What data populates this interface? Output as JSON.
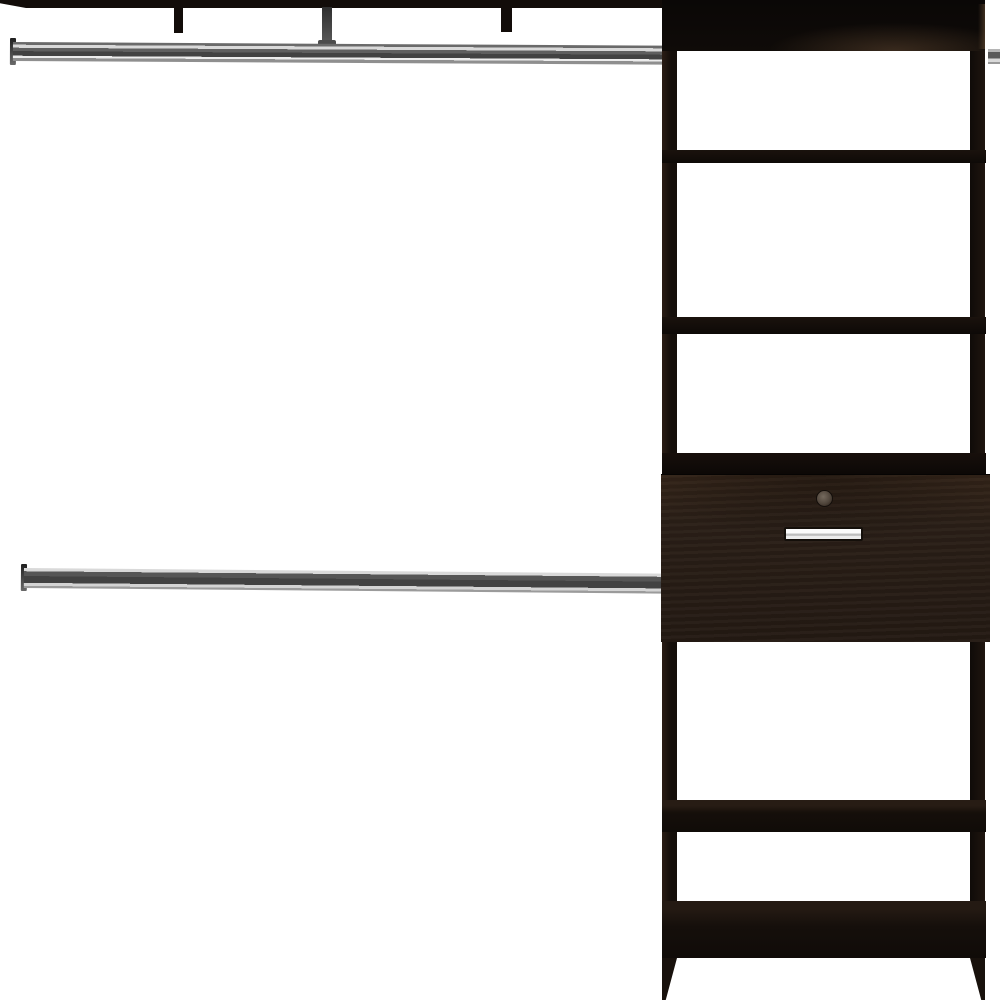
{
  "scene": {
    "description": "Product photo of a dark espresso closet organizer system: an upper hanging rod under a top mounting shelf, a lower hanging rod, and a tall shelf tower on the right with four shelves, an enclosed top cabinet, a drawer with a metal pull handle and cam-lock knob, a base shelf and tapered feet, on a plain white background",
    "background_label": "white studio background",
    "left_section": {
      "top_shelf": "top mounting shelf",
      "supports": [
        {
          "label": "shelf hanger support (left)"
        },
        {
          "label": "rod hanger support (center)"
        },
        {
          "label": "shelf hanger support (right)"
        }
      ],
      "upper_rod": "chrome hanging rod (upper, full width)",
      "lower_rod": "chrome hanging rod (lower, mid height)",
      "rod_end_bracket": "rod end mounting bracket"
    },
    "tower": {
      "top_cabinet": "enclosed top cabinet panel",
      "side_panels": [
        "left side panel",
        "right side panel"
      ],
      "shelves": [
        "upper shelf 1",
        "upper shelf 2",
        "shelf above drawer",
        "lower shelf",
        "base shelf"
      ],
      "drawer": {
        "front": "drawer front",
        "knob": "cam-lock knob",
        "handle": "brushed metal pull handle"
      },
      "feet": [
        "left tapered foot",
        "right tapered foot"
      ],
      "right_rod_stub": "hanging rod continuing right of tower"
    }
  },
  "colors": {
    "bg": "#ffffff",
    "wood-black": "#120c09",
    "wood-dark": "#140e0a",
    "espresso": "#2a1f17",
    "espresso-light": "#3a2b20",
    "chrome-light": "#d9d9d9",
    "chrome-mid": "#8f8f8f",
    "chrome-dark": "#424242",
    "handle-silver": "#dedede",
    "knob-gray": "#50463c"
  }
}
